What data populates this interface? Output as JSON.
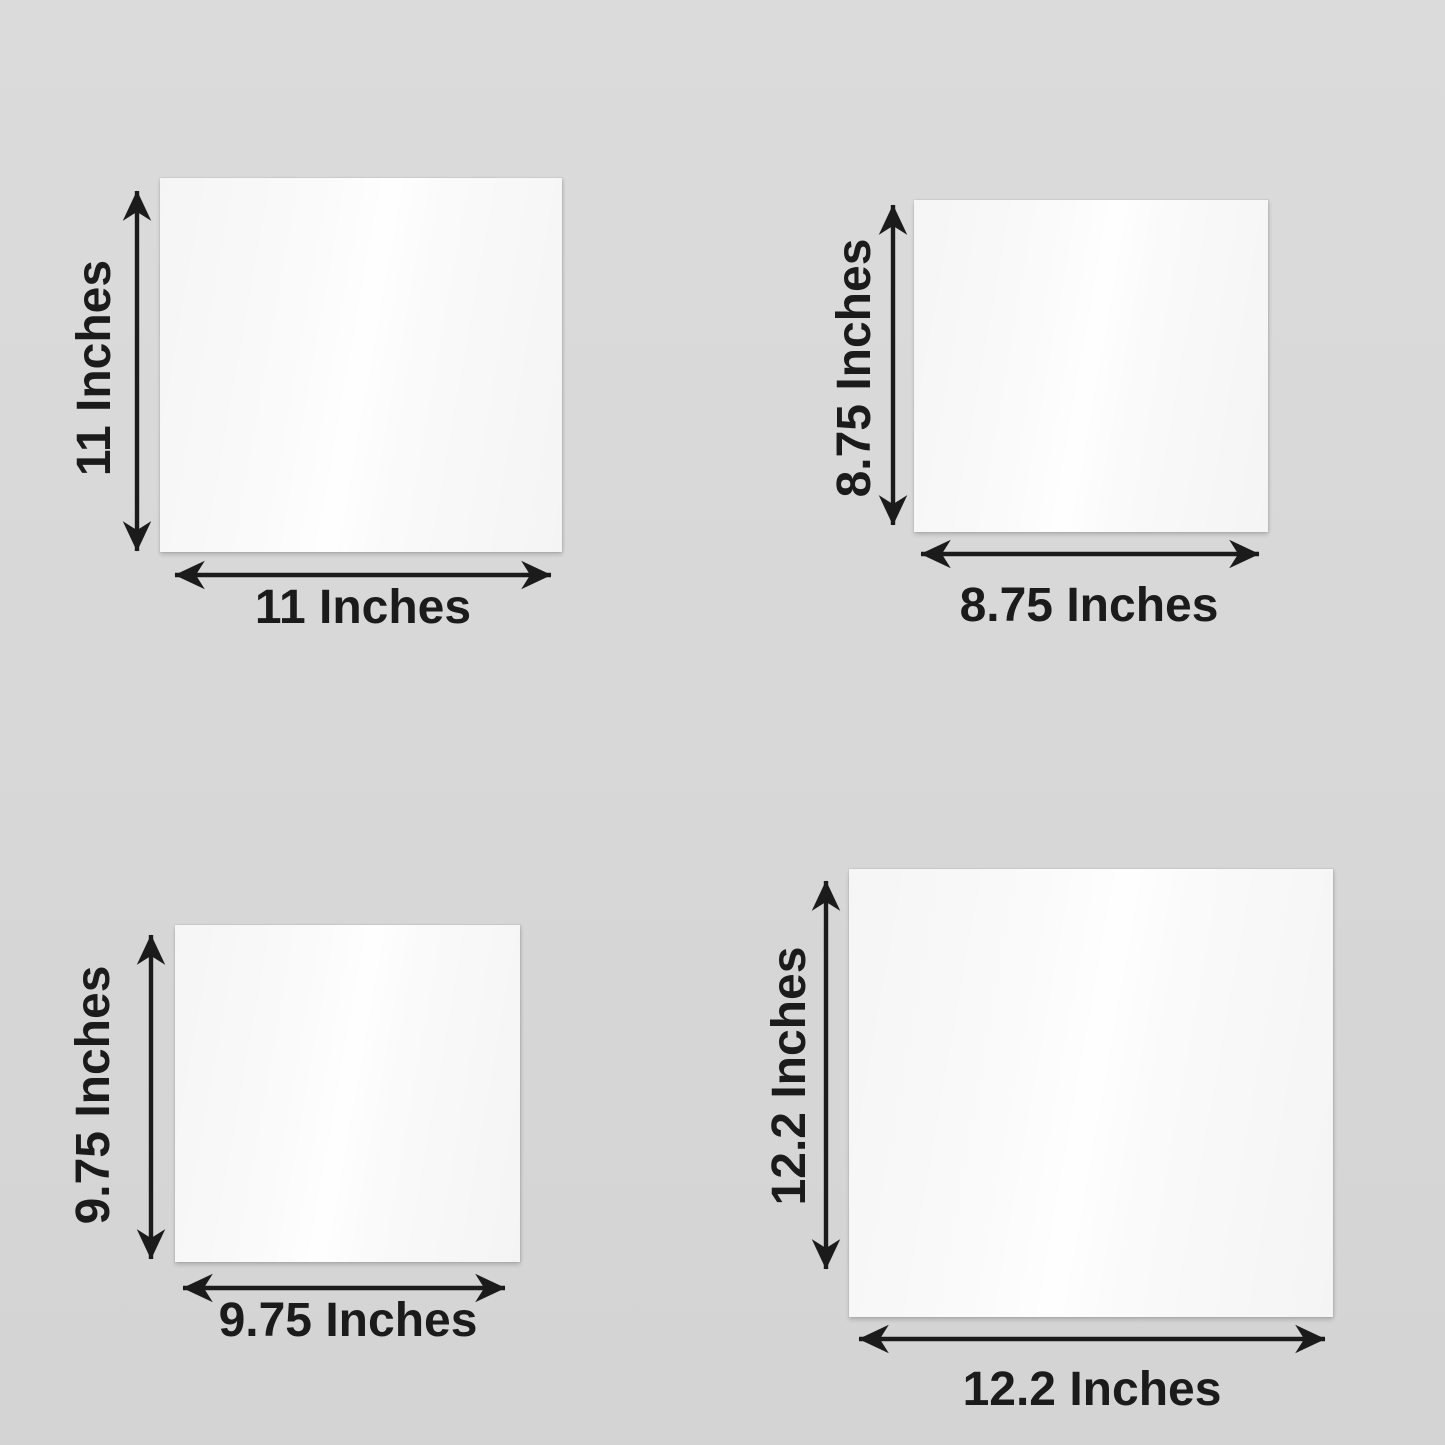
{
  "colors": {
    "background": "#d8d8d8",
    "ink": "#1b1b1b",
    "sheet": "#fafafa"
  },
  "panels": [
    {
      "id": "top-left",
      "size_inches": 11,
      "width_label": "11 Inches",
      "height_label": "11 Inches"
    },
    {
      "id": "top-right",
      "size_inches": 8.75,
      "width_label": "8.75 Inches",
      "height_label": "8.75 Inches"
    },
    {
      "id": "bottom-left",
      "size_inches": 9.75,
      "width_label": "9.75 Inches",
      "height_label": "9.75 Inches"
    },
    {
      "id": "bottom-right",
      "size_inches": 12.2,
      "width_label": "12.2 Inches",
      "height_label": "12.2 Inches"
    }
  ]
}
